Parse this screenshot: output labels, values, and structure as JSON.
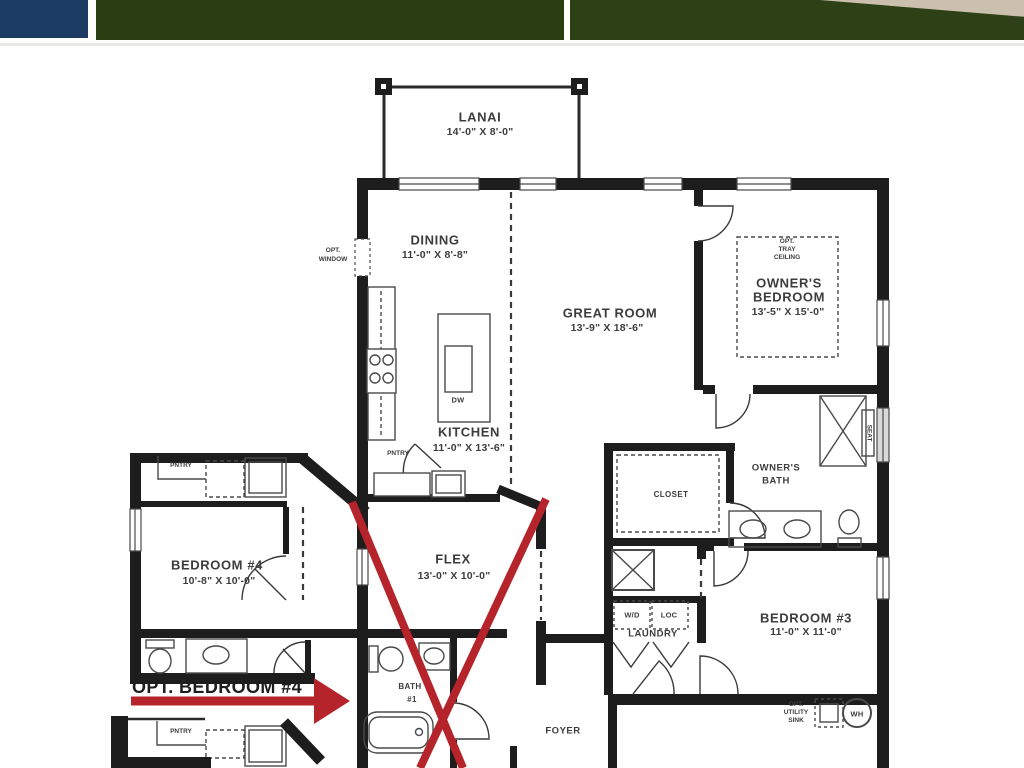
{
  "photo_strip": {
    "thumb1_color": "#1d3c63",
    "thumb2_color": "#2b3d13",
    "thumb3_grass_color": "#2e4016",
    "thumb3_pavement_color": "#cbbfae"
  },
  "plan": {
    "ink_color": "#1d1d1d",
    "label_color": "#3d3d3d",
    "red_color": "#b5242b",
    "rooms": [
      {
        "id": "lanai",
        "name": "LANAI",
        "dims": "14'-0\" X 8'-0\""
      },
      {
        "id": "dining",
        "name": "DINING",
        "dims": "11'-0\" X 8'-8\""
      },
      {
        "id": "great-room",
        "name": "GREAT ROOM",
        "dims": "13'-9\" X 18'-6\""
      },
      {
        "id": "owners-bedroom",
        "name": "OWNER'S",
        "name2": "BEDROOM",
        "dims": "13'-5\" X 15'-0\""
      },
      {
        "id": "kitchen",
        "name": "KITCHEN",
        "dims": "11'-0\" X 13'-6\""
      },
      {
        "id": "flex",
        "name": "FLEX",
        "dims": "13'-0\" X 10'-0\""
      },
      {
        "id": "bedroom-4",
        "name": "BEDROOM #4",
        "dims": "10'-8\" X 10'-0\""
      },
      {
        "id": "bedroom-3",
        "name": "BEDROOM #3",
        "dims": "11'-0\" X 11'-0\""
      },
      {
        "id": "closet",
        "name": "CLOSET"
      },
      {
        "id": "owners-bath",
        "name": "OWNER'S",
        "name2": "BATH"
      },
      {
        "id": "laundry",
        "name": "LAUNDRY"
      },
      {
        "id": "foyer",
        "name": "FOYER"
      },
      {
        "id": "bath-1",
        "name": "BATH",
        "name2": "#1"
      }
    ],
    "small_labels": {
      "opt_window1": "OPT.",
      "opt_window2": "WINDOW",
      "tray1": "OPT.",
      "tray2": "TRAY",
      "tray3": "CEILING",
      "pntry": "PNTRY",
      "wd": "W/D",
      "loc": "LOC",
      "dw": "DW",
      "seat": "SEAT",
      "wh": "WH",
      "util1": "OPT.",
      "util2": "UTILITY",
      "util3": "SINK"
    },
    "annotation": {
      "opt_bedroom4": "OPT. BEDROOM #4"
    }
  }
}
